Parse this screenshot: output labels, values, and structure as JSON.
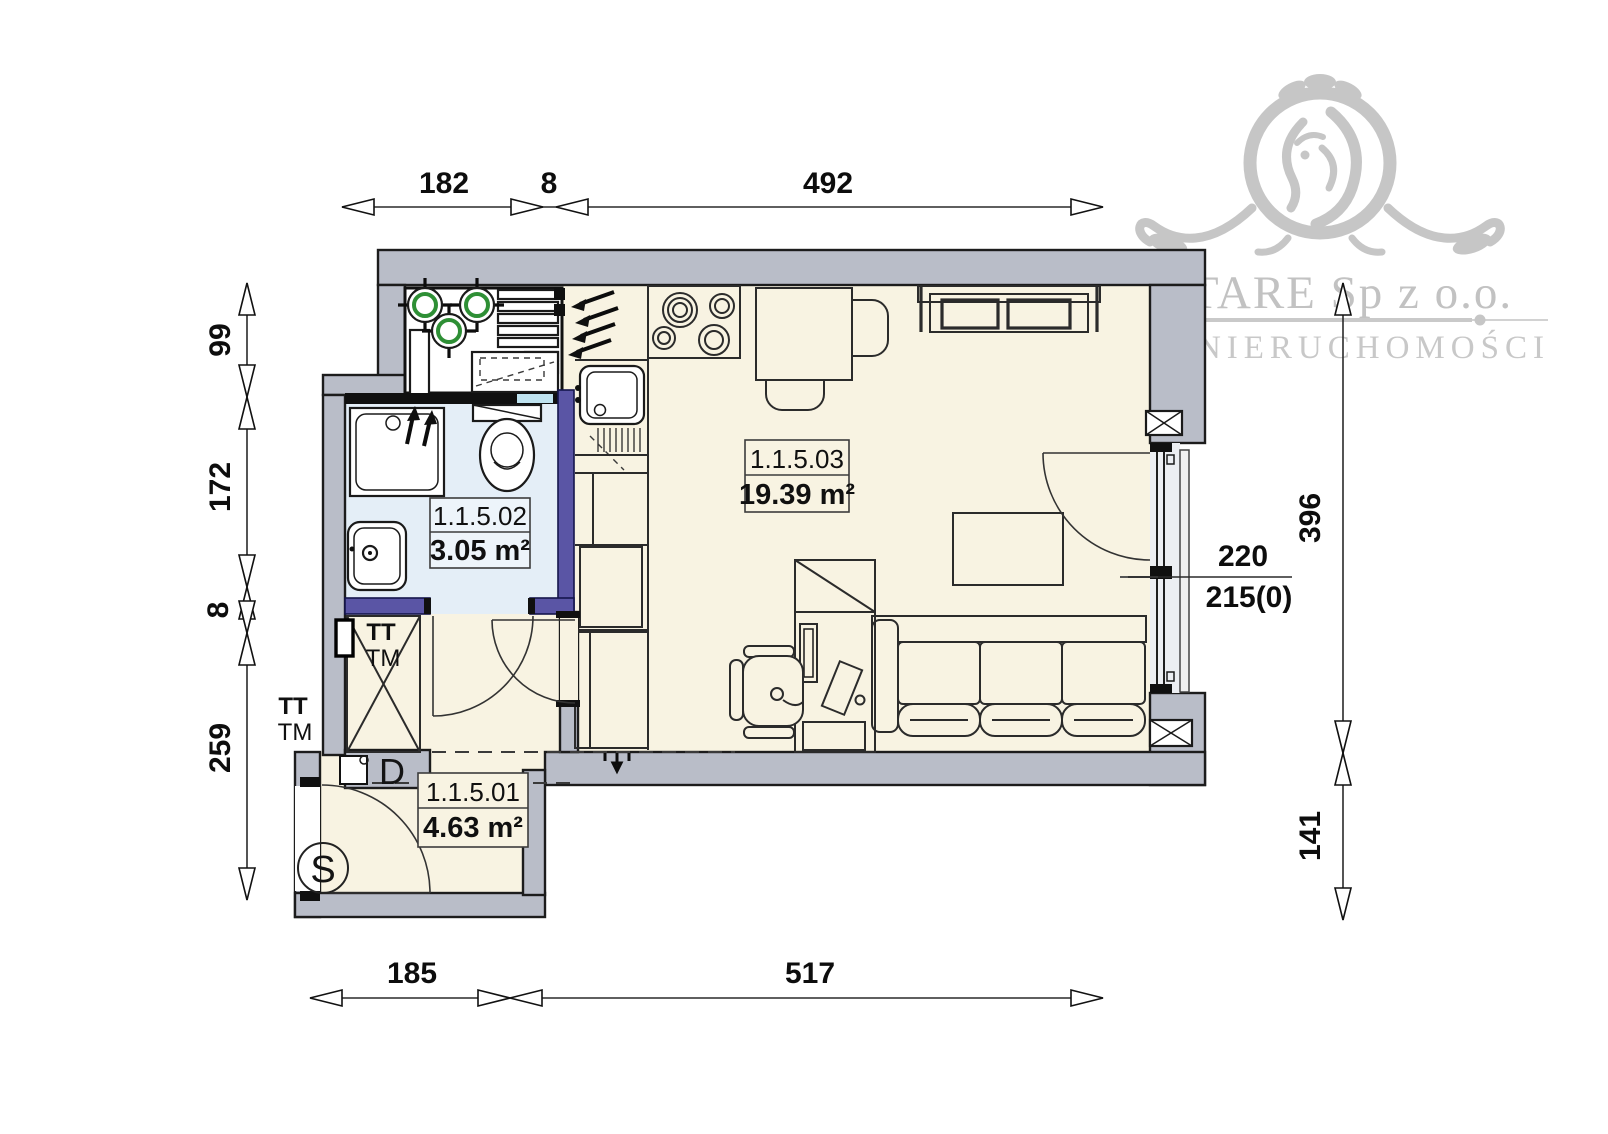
{
  "logo": {
    "company": "ELITARE Sp z o.o.",
    "subtitle": "BIURO NIERUCHOMOŚCI"
  },
  "rooms": [
    {
      "id": "1.1.5.01",
      "area": "4.63 m²"
    },
    {
      "id": "1.1.5.02",
      "area": "3.05 m²"
    },
    {
      "id": "1.1.5.03",
      "area": "19.39 m²"
    }
  ],
  "dimensions": {
    "top": [
      "182",
      "8",
      "492"
    ],
    "left": [
      "99",
      "172",
      "8",
      "259"
    ],
    "right": [
      "396",
      "141"
    ],
    "bottom": [
      "185",
      "517"
    ],
    "window": {
      "upper": "220",
      "lower": "215(0)"
    }
  },
  "annotations": {
    "tt": "TT",
    "tm": "TM",
    "door_label": "D",
    "entrance_label": "S"
  },
  "colors": {
    "wall": "#b9bdc8",
    "floor": "#f8f3e2",
    "bathroom_floor": "#e4eef7",
    "accent_wall": "#5a55a5",
    "vent_green": "#2e8f35",
    "logo_gray": "#c6c6c6"
  }
}
